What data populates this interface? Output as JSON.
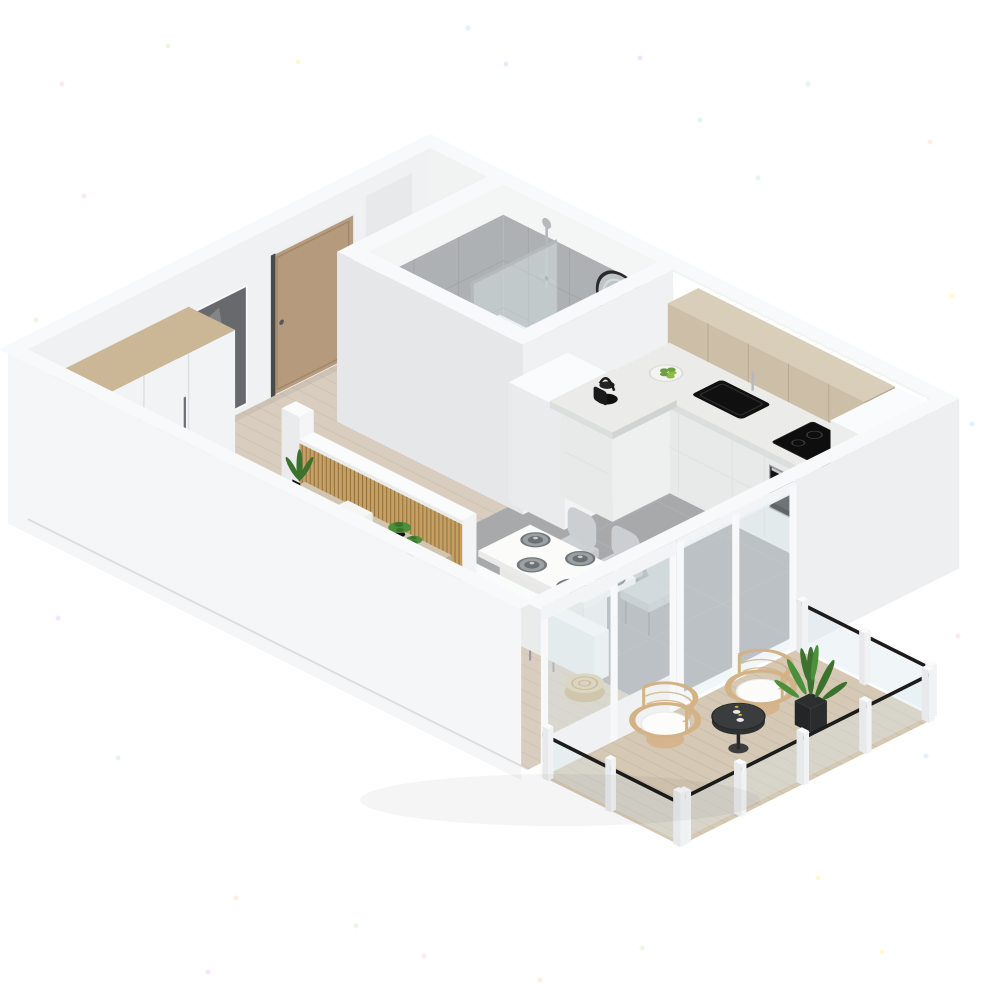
{
  "title": "3D isometric apartment floor plan render",
  "colors": {
    "background": "#ffffff",
    "wall_top": "#f8f9fa",
    "wall_face_se": "#eff1f2",
    "wall_face_sw": "#e5e7e9",
    "wall_outline": "#d8dadc",
    "bath_tile": "#aeb1b3",
    "bath_tile_line": "#9da0a3",
    "bath_floor": "#e2e3e3",
    "window_glow": "#ffffff",
    "wood_floor": "#d8cdbe",
    "wood_floor_line": "#c6b9a7",
    "gray_floor": "#a7a9ab",
    "gray_floor_line": "#b5b7b9",
    "balcony_wood": "#d5c8b4",
    "balcony_wood_line": "#c2b29c",
    "rug": "#e8e3da",
    "cabinet_white": "#f5f6f6",
    "counter_top": "#ebecea",
    "upper_cabinet_wood": "#cdbfa7",
    "upper_cabinet_seam": "#b7a88e",
    "wardrobe_oak": "#cbb795",
    "slat_wood": "#c59f63",
    "slat_gap": "#7c5f35",
    "console_taupe": "#d2c5b2",
    "door_oak": "#b59a7d",
    "niche_dark": "#67696c",
    "appliance_black": "#141414",
    "fixture_chrome": "#b5b9bb",
    "glass": "#dceaee",
    "railing_black": "#1c1c1c",
    "chair_gray": "#c5c9cc",
    "blanket_gray": "#9aa0a9",
    "sheet_white": "#edecea",
    "pillow_white": "#fbfbfa",
    "pillow_blush": "#d9c8c4",
    "rattan": "#d3b286",
    "cushion_white": "#fcfcfb",
    "plant_green": "#4e8f3c",
    "plant_green_dark": "#3c712e",
    "fruit_green": "#8fba4a",
    "table_black": "#3a3c3e",
    "mirror_frame": "#2a2a2a",
    "mirror_glass": "#bfc5c7"
  },
  "scene": {
    "view": "isometric dollhouse cutaway, white background with pastel noise specks",
    "rooms": [
      {
        "id": "bathroom",
        "label": "Bathroom",
        "furniture": [
          "bathtub",
          "glass shower screen",
          "shower fixture",
          "round wall mirror",
          "washbasin",
          "service column"
        ]
      },
      {
        "id": "kitchen",
        "label": "Kitchen",
        "furniture": [
          "wood upper cabinets",
          "white base cabinets",
          "L-shaped countertop",
          "black sink",
          "faucet",
          "induction cooktop",
          "built-in oven",
          "tall cabinet with microwave",
          "kettle",
          "fruit bowl",
          "pepper mills"
        ]
      },
      {
        "id": "dining-area",
        "label": "Dining area",
        "furniture": [
          "white dining table",
          "gray shell chairs",
          "gray place settings",
          "rattan pouf"
        ]
      },
      {
        "id": "entry-hall",
        "label": "Entry hall",
        "furniture": [
          "oak entry door",
          "dark wall niche with mirror",
          "white wardrobe with oak top",
          "oak sideboard",
          "white door leaf"
        ]
      },
      {
        "id": "bedroom",
        "label": "Bedroom",
        "furniture": [
          "double bed",
          "gray blanket",
          "white and blush pillows",
          "area rug",
          "black nightstand",
          "black bench with plant",
          "floating TV console",
          "wood slat divider",
          "small potted plants"
        ]
      },
      {
        "id": "balcony",
        "label": "Balcony",
        "furniture": [
          "rattan armchair",
          "rattan armchair",
          "black round side table with candles",
          "potted plant",
          "glass railing with black handrail"
        ]
      }
    ]
  }
}
